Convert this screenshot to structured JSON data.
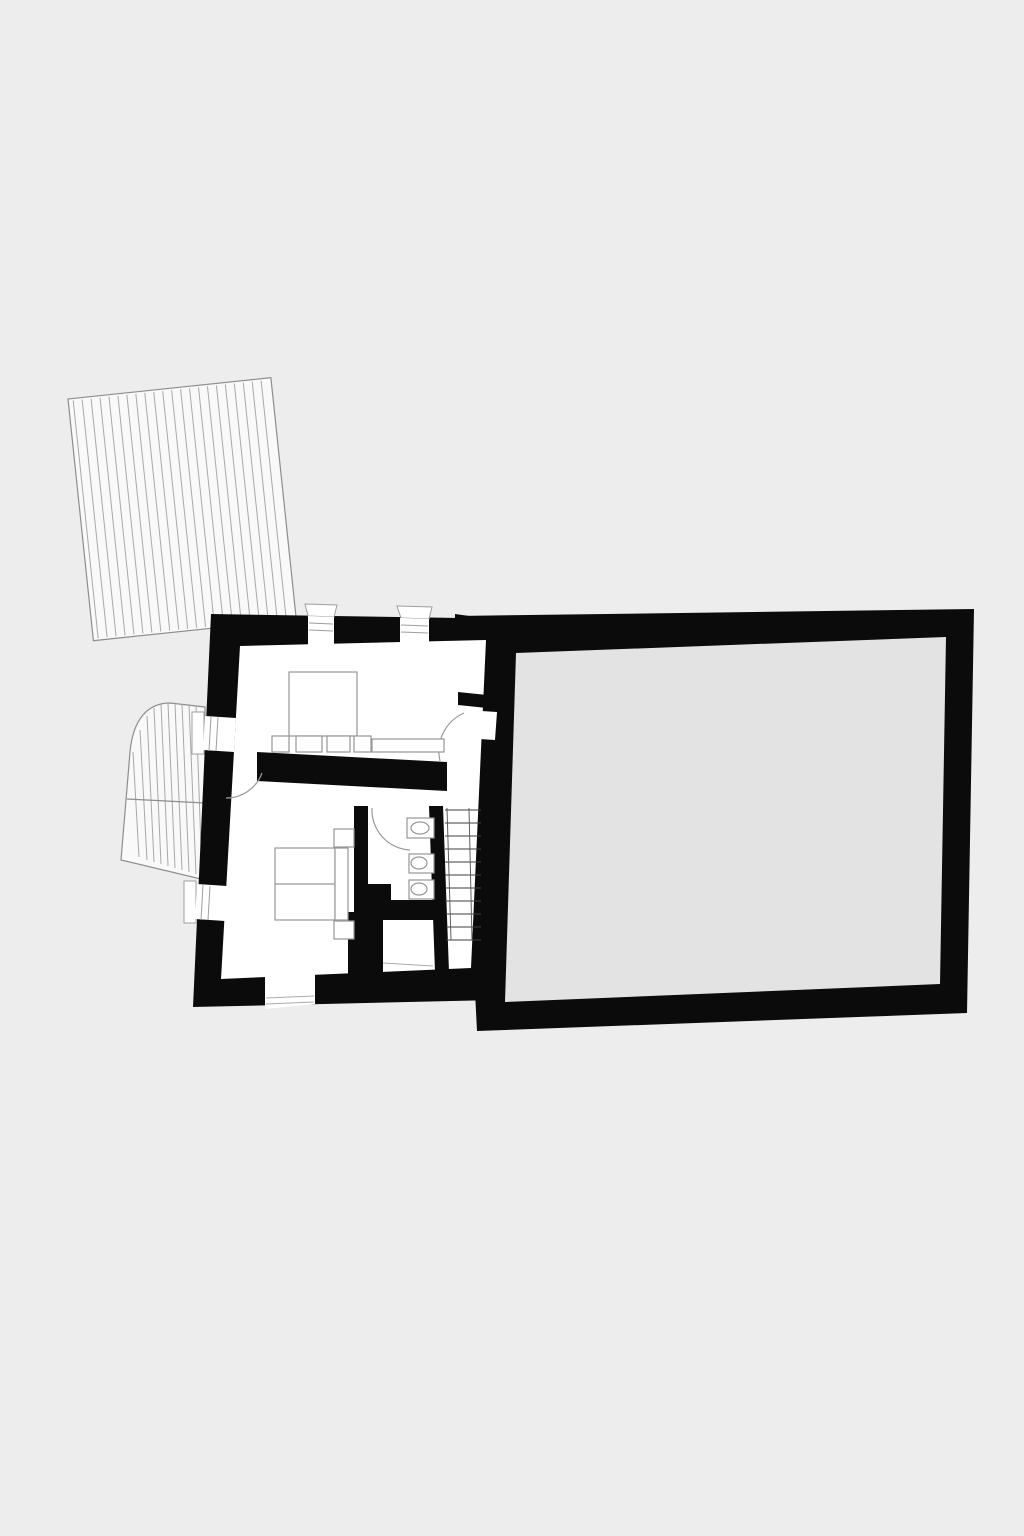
{
  "document": {
    "kind": "architectural floor plan drawing",
    "orientation": "portrait",
    "visible_text": "none"
  },
  "colors": {
    "background": "#ededed",
    "wall": "#0b0b0b",
    "interior": "#ffffff",
    "annex_fill": "#e3e3e3",
    "furniture_stroke": "#979797",
    "hatch_fill": "#f9f9f9",
    "hatch_line": "#a8a8a8",
    "hatch_outline": "#8d8d8d",
    "stair_tread": "#3d3d3d",
    "stair_rail": "#5f5f5f",
    "door_arc": "#9a9a9a",
    "threshold_line": "#ababab",
    "glazing_line": "#9f9f9f"
  },
  "plan": {
    "areas": [
      {
        "name": "hatched-roof-area",
        "style": "parallel line hatching, slightly rotated"
      },
      {
        "name": "curved-hatched-area",
        "style": "hatched shape with rounded corner against left wall"
      },
      {
        "name": "main-building",
        "style": "thick black masonry walls, white interior"
      },
      {
        "name": "annex-hall",
        "style": "thick black wall frame with plain gray fill"
      }
    ],
    "main_building": {
      "upper_room_furniture": [
        "bed",
        "sideboard-row"
      ],
      "lower_room_furniture": [
        "double-bed",
        "headboard",
        "nightstand",
        "nightstand"
      ],
      "bathroom_fixtures": [
        "sink",
        "toilet",
        "bidet"
      ],
      "doors": [
        "upper-room-door",
        "dividing-wall-door",
        "bathroom-door",
        "entrance-door"
      ],
      "windows": [
        "top-wall-window-1",
        "top-wall-window-2",
        "left-wall-window-1",
        "left-wall-window-2"
      ]
    },
    "staircase": {
      "tread_count": 11,
      "rails": 2
    }
  }
}
